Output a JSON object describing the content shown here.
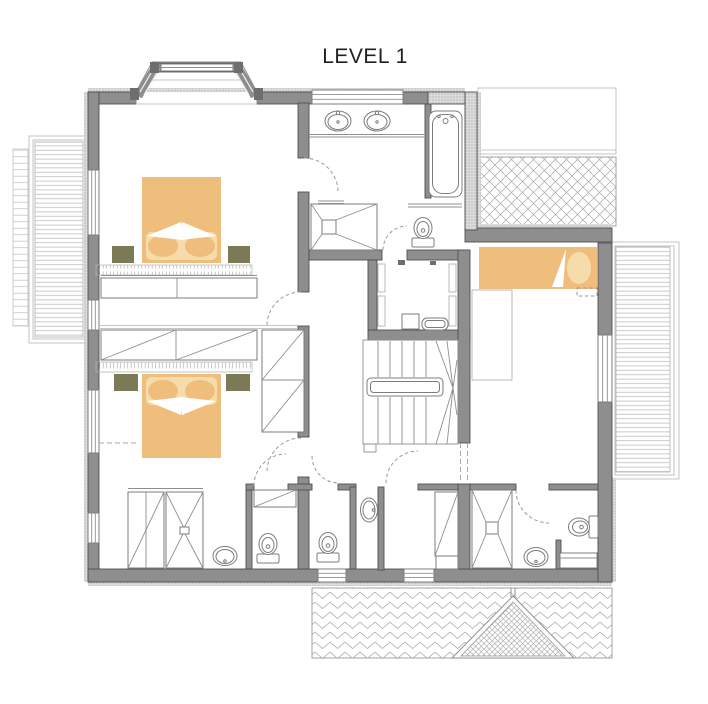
{
  "title": "LEVEL 1",
  "colors": {
    "wall": "#8e8e8e",
    "wall_edge": "#4f4f4f",
    "bed": "#efbe7c",
    "bed_light": "#f7dcab",
    "nightstand": "#7b7956",
    "line": "#8f8f8f",
    "roof_hatch": "#a8a8a8",
    "deck": "#bcbcbc",
    "title_color": "#1f1f1f"
  }
}
